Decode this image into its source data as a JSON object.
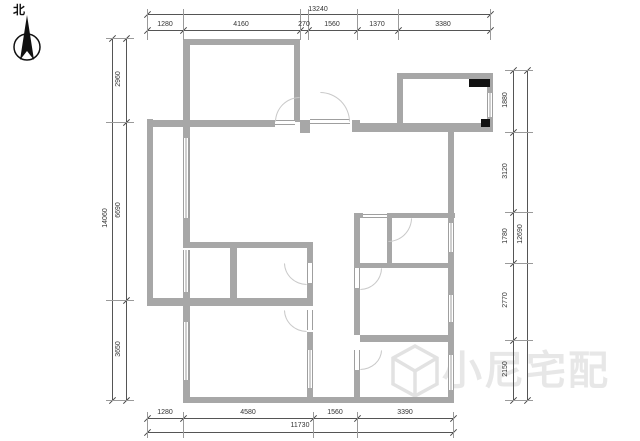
{
  "north_label": "北",
  "watermark": {
    "text": "小尼宅配"
  },
  "dimensions": {
    "top": {
      "total": "13240",
      "segments": [
        "1280",
        "4160",
        "270",
        "1560",
        "1370",
        "3380"
      ]
    },
    "bottom": {
      "total": "11730",
      "segments": [
        "1280",
        "4580",
        "1560",
        "3390"
      ]
    },
    "left": {
      "total": "14060",
      "segments": [
        "2960",
        "6690",
        "3650"
      ]
    },
    "right": {
      "total": "12690",
      "segments": [
        "1880",
        "3120",
        "1780",
        "2770",
        "2150"
      ]
    }
  }
}
